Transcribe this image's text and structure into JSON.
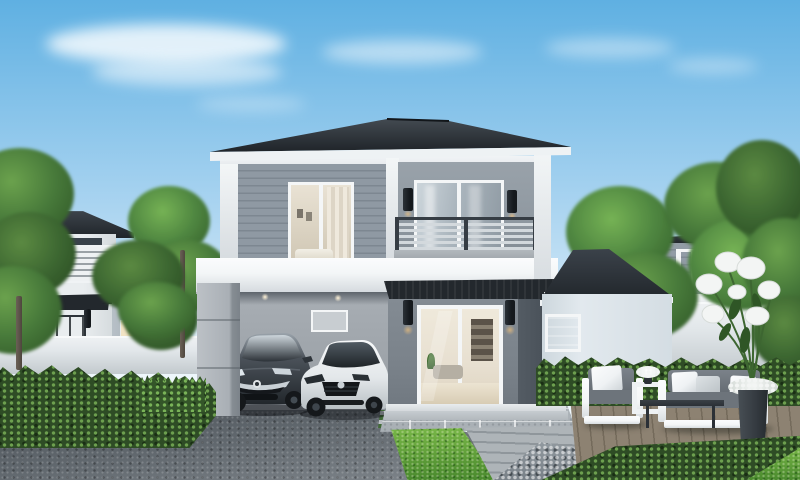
{
  "scene": {
    "type": "architectural-render",
    "description": "Modern two-storey grey and white detached house with dark hip roof, double carport with two parked cars, first-floor balcony, landscaped front garden with lawn, hedges, stone driveway, timber deck with white outdoor lounge set and tall planter of white flowers, flanked by neighbouring houses and leafy trees under a clear blue sky",
    "objects": {
      "sky": "clear blue sky with wispy clouds",
      "main_house": "two-storey grey/white house with dark hip roof",
      "balcony": "balcony with horizontal slatted railing and glass door",
      "bedroom_window": "large upper window with warm lit bedroom",
      "carport": "double carport under the second floor",
      "car_dark": "dark grey hatchback with chrome grille",
      "car_white": "white coupe",
      "entrance": "glass sliding door with black awning and wall sconces",
      "side_wing": "single-storey wing with hip roof and window",
      "left_house": "neighbouring white two-storey house with balcony",
      "right_house": "neighbouring grey two-storey house with lit windows",
      "fence": "low white boundary wall",
      "hedges": "trimmed green hedges",
      "driveway": "dark speckled stone driveway",
      "patio": "light grey tiled patio and paver path",
      "deck": "timber deck with outdoor sofa, armchair and tables",
      "planter": "tall dark planter with white lily bouquet",
      "trees": "leafy green trees"
    },
    "colors": {
      "sky_top": "#5fb0e2",
      "sky_mid": "#a8d3f0",
      "sky_horizon": "#edf6fb",
      "cloud": "#ffffff",
      "roof_top": "#3e454c",
      "roof_bottom": "#1f2429",
      "fascia": "#eef2f4",
      "soffit": "#f1f4f6",
      "siding": "#8f99a3",
      "siding_line": "#7d8791",
      "wall_balcony": "#9099a1",
      "white_trim": "#f3f6f7",
      "trim_shadow": "#d6dbdf",
      "slab_edge": "#b2b8bd",
      "railing_bar": "#d3d9dd",
      "railing_frame": "#363d44",
      "sconce": "#15191d",
      "glass_light": "#ccd5db",
      "glass_dark": "#8e99a2",
      "interior_warm": "#e7dfd0",
      "interior_deep": "#cec5b2",
      "awning": "#23282d",
      "wall_lower": "#7b838b",
      "wall_lower_dark": "#545c64",
      "carport_wall": "#a8aeb4",
      "carport_ceiling": "#5d646b",
      "pillar_face": "#bcc1c6",
      "pillar_side": "#868d93",
      "wing_wall": "#e2e9ee",
      "window_frame": "#f4f6f7",
      "fence_light": "#eef1f3",
      "fence_shade": "#c2c9cd",
      "lh_wall": "#e9edef",
      "lit_window": "#f1e3c4",
      "rh_siding": "#959ea8",
      "rh_dark": "#4a525a",
      "asphalt_dark": "#494f56",
      "asphalt_light": "#8a9096",
      "tile": "#b6bcc1",
      "lawn_light": "#79b748",
      "lawn_dark": "#4a8a2e",
      "hedge": "#2e4c25",
      "hedge_dot": "#6da04f",
      "gravel": "#99a1a7",
      "deck_plank": "#8d8272",
      "deck_gap": "#746a5b",
      "tree_light": "#6ba24d",
      "tree_mid": "#47793a",
      "tree_dark": "#2f5626",
      "trunk": "#6b6156",
      "tire": "#15181b",
      "chrome": "#c9d0d5",
      "car_dark_body": "#2e343a",
      "car_dark_hood": "#9aa3ab",
      "car_glass": "#2a3036",
      "car_white_body": "#f2f4f5",
      "car_white_shade": "#bac1c5",
      "cushion_back": "#7b828a",
      "cushion_seat": "#6d747b",
      "pillow": "#eff2f4",
      "frame_white": "#f4f6f7",
      "table_dark": "#2b3036",
      "planter_dark": "#363c42",
      "flower": "#f3f5f4",
      "stem": "#3d6631"
    }
  }
}
